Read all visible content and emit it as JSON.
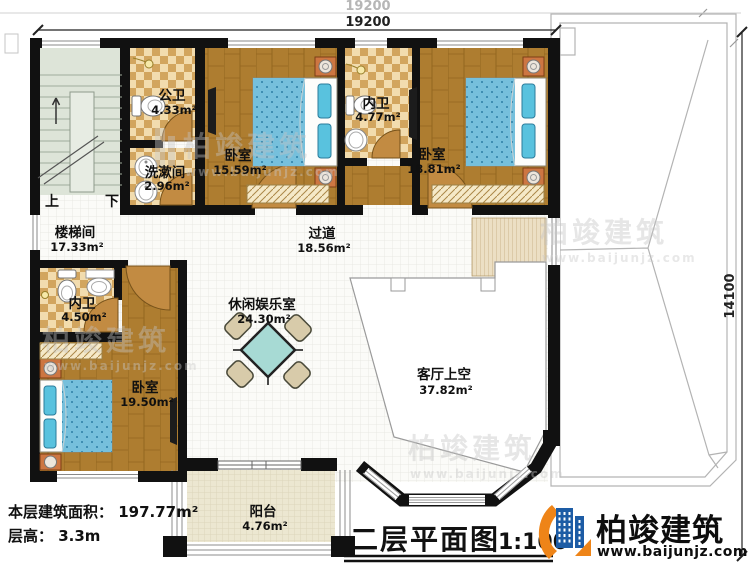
{
  "title": {
    "name": "二层平面图",
    "scale": "1:100"
  },
  "brand": {
    "name": "柏竣建筑",
    "site": "www.baijunjz.com"
  },
  "watermark": {
    "name": "柏竣建筑",
    "site": "www.baijunjz.com"
  },
  "footer": {
    "floor_area": "本层建筑面积： 197.77m²",
    "floor_height": "层高： 3.3m"
  },
  "dimensions": {
    "top": "19200",
    "top_outer": "19200",
    "right": "14100"
  },
  "stairs": {
    "up": "上",
    "down": "下"
  },
  "rooms": [
    {
      "id": "public-bath",
      "name": "公卫",
      "area": "4.33m²"
    },
    {
      "id": "washroom",
      "name": "洗漱间",
      "area": "2.96m²"
    },
    {
      "id": "bedroom-top",
      "name": "卧室",
      "area": "15.59m²"
    },
    {
      "id": "ensuite-top",
      "name": "内卫",
      "area": "4.77m²"
    },
    {
      "id": "bedroom-right",
      "name": "卧室",
      "area": "18.81m²"
    },
    {
      "id": "stair-hall",
      "name": "楼梯间",
      "area": "17.33m²"
    },
    {
      "id": "hallway",
      "name": "过道",
      "area": "18.56m²"
    },
    {
      "id": "ensuite-left",
      "name": "内卫",
      "area": "4.50m²"
    },
    {
      "id": "leisure-room",
      "name": "休闲娱乐室",
      "area": "24.30m²"
    },
    {
      "id": "bedroom-bottom",
      "name": "卧室",
      "area": "19.50m²"
    },
    {
      "id": "living-void",
      "name": "客厅上空",
      "area": "37.82m²"
    },
    {
      "id": "balcony",
      "name": "阳台",
      "area": "4.76m²"
    }
  ]
}
